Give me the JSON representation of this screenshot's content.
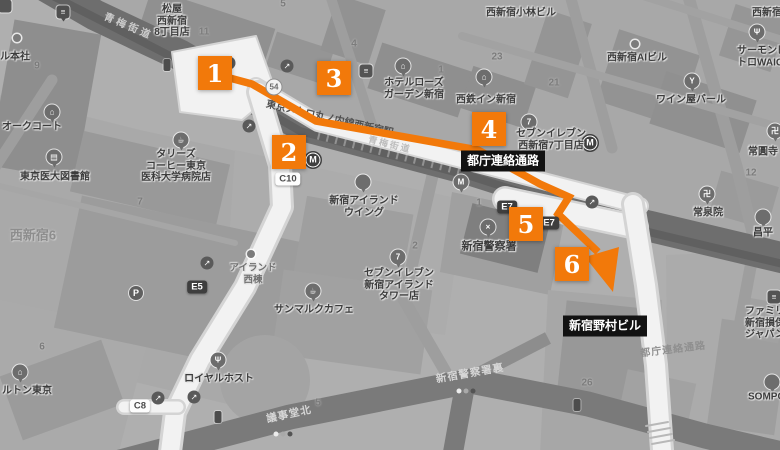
{
  "colors": {
    "route_orange": "#F2790A",
    "label_bg": "#121212",
    "map_background": "#afafaf",
    "road_dark": "#6e6e6e",
    "corridor_white": "#f2f2f2"
  },
  "route": {
    "via_label": "都庁連絡通路",
    "destination_label": "新宿野村ビル",
    "markers": [
      {
        "label": "1",
        "x": 215,
        "y": 73
      },
      {
        "label": "2",
        "x": 289,
        "y": 152
      },
      {
        "label": "3",
        "x": 334,
        "y": 78
      },
      {
        "label": "4",
        "x": 489,
        "y": 129
      },
      {
        "label": "5",
        "x": 526,
        "y": 224
      },
      {
        "label": "6",
        "y": 264,
        "x": 572
      }
    ]
  },
  "black_labels": [
    {
      "name": "tocho-passage-label",
      "text": "都庁連絡通路",
      "x": 503,
      "y": 161
    },
    {
      "name": "nomura-building-label",
      "text": "新宿野村ビル",
      "x": 605,
      "y": 326
    }
  ],
  "pois": [
    {
      "name": "honsha-label",
      "lines": [
        "ル本社"
      ],
      "x": 15,
      "y": 57
    },
    {
      "name": "matsuya-label",
      "lines": [
        "松屋",
        "西新宿",
        "8丁目店"
      ],
      "x": 172,
      "y": 21
    },
    {
      "name": "oak-court-label",
      "lines": [
        "オークコート"
      ],
      "x": 32,
      "y": 127
    },
    {
      "name": "kobayashi-bldg-label",
      "lines": [
        "西新宿小林ビル"
      ],
      "x": 521,
      "y": 13
    },
    {
      "name": "nishi-shinjuku-partial-label",
      "lines": [
        "西新宿"
      ],
      "x": 752,
      "y": 13,
      "align": "left"
    },
    {
      "name": "salmon-waiga-label",
      "lines": [
        "サーモンピ",
        "トロWAIGA"
      ],
      "x": 737,
      "y": 57,
      "align": "left"
    },
    {
      "name": "ai-bldg-label",
      "lines": [
        "西新宿AIビル"
      ],
      "x": 637,
      "y": 58
    },
    {
      "name": "wine-bar-label",
      "lines": [
        "ワイン屋バール"
      ],
      "x": 691,
      "y": 100
    },
    {
      "name": "hotel-rose-garden-label",
      "lines": [
        "ホテルローズ",
        "ガーデン新宿"
      ],
      "x": 414,
      "y": 89
    },
    {
      "name": "nishitetsu-inn-label",
      "lines": [
        "西鉄イン新宿"
      ],
      "x": 486,
      "y": 100
    },
    {
      "name": "seven-eleven-nishi7-label",
      "lines": [
        "セブンイレブン",
        "西新宿7丁目店"
      ],
      "x": 551,
      "y": 140
    },
    {
      "name": "tullys-label",
      "lines": [
        "タリーズ",
        "コーヒー東京",
        "医科大学病院店"
      ],
      "x": 176,
      "y": 166
    },
    {
      "name": "med-library-label",
      "lines": [
        "東京医大図書館"
      ],
      "x": 55,
      "y": 177
    },
    {
      "name": "island-wing-label",
      "lines": [
        "新宿アイランド",
        "ウイング"
      ],
      "x": 364,
      "y": 207
    },
    {
      "name": "island-west-label",
      "lines": [
        "アイランド",
        "西棟"
      ],
      "x": 253,
      "y": 274,
      "size": 9.5,
      "color": "#6f6f6f"
    },
    {
      "name": "seven-eleven-island-label",
      "lines": [
        "セブンイレブン",
        "新宿アイランド",
        "タワー店"
      ],
      "x": 399,
      "y": 285
    },
    {
      "name": "police-hq-label",
      "lines": [
        "新宿警察署"
      ],
      "x": 489,
      "y": 247,
      "size": 11
    },
    {
      "name": "josenin-label",
      "lines": [
        "常泉院"
      ],
      "x": 708,
      "y": 213
    },
    {
      "name": "joenji-label",
      "lines": [
        "常圓寺"
      ],
      "x": 748,
      "y": 152,
      "align": "left"
    },
    {
      "name": "familymart-label",
      "lines": [
        "ファミリー",
        "新宿損保",
        "ジャパン"
      ],
      "x": 745,
      "y": 323,
      "align": "left"
    },
    {
      "name": "shohei-label",
      "lines": [
        "昌平"
      ],
      "x": 763,
      "y": 233
    },
    {
      "name": "sompo-label",
      "lines": [
        "SOMPO"
      ],
      "x": 748,
      "y": 397,
      "align": "left"
    },
    {
      "name": "sanmarc-label",
      "lines": [
        "サンマルクカフェ"
      ],
      "x": 314,
      "y": 310
    },
    {
      "name": "royal-host-label",
      "lines": [
        "ロイヤルホスト"
      ],
      "x": 219,
      "y": 379
    },
    {
      "name": "hilton-label",
      "lines": [
        "ルトン東京"
      ],
      "x": 27,
      "y": 391
    }
  ],
  "area_labels": [
    {
      "name": "district-nishi-shinjuku-6",
      "text": "西新宿6",
      "x": 33,
      "y": 234
    }
  ],
  "road_labels": [
    {
      "name": "ome-kaido-label",
      "text": "青梅街道",
      "x": 129,
      "y": 25,
      "rot": 23,
      "color": "#cccccc",
      "size": 10,
      "ls": 3
    },
    {
      "name": "ome-kaido-label-2",
      "text": "青梅街道",
      "x": 390,
      "y": 144,
      "rot": 14,
      "color": "#bdbdbd",
      "size": 9,
      "ls": 2
    },
    {
      "name": "marunouchi-line-label",
      "text": "東京メトロ丸ノ内線西新宿駅",
      "x": 330,
      "y": 117,
      "rot": 13,
      "color": "#4f4f4f",
      "size": 10,
      "ls": 0
    },
    {
      "name": "gijido-kita-label",
      "text": "議事堂北",
      "x": 289,
      "y": 414,
      "rot": -12,
      "color": "#d6d6d6",
      "size": 10.5,
      "ls": 1
    },
    {
      "name": "police-ura-label",
      "text": "新宿警察署裏",
      "x": 470,
      "y": 373,
      "rot": -10,
      "color": "#d6d6d6",
      "size": 10.5,
      "ls": 1
    },
    {
      "name": "tocho-corridor-label",
      "text": "都庁連絡通路",
      "x": 673,
      "y": 348,
      "rot": -7,
      "color": "#8f8f8f",
      "size": 10,
      "ls": 1
    }
  ],
  "exit_labels": [
    {
      "name": "exit-c10",
      "text": "C10",
      "x": 288,
      "y": 179,
      "dark": false
    },
    {
      "name": "exit-c8",
      "text": "C8",
      "x": 140,
      "y": 406,
      "dark": false
    },
    {
      "name": "exit-e5",
      "text": "E5",
      "x": 197,
      "y": 287,
      "dark": true
    },
    {
      "name": "exit-e7",
      "text": "E7",
      "x": 507,
      "y": 207,
      "dark": true
    },
    {
      "name": "exit-e7",
      "text": "E7",
      "x": 549,
      "y": 223,
      "dark": true
    }
  ],
  "block_numbers": [
    {
      "text": "9",
      "x": 37,
      "y": 66
    },
    {
      "text": "11",
      "x": 204,
      "y": 32
    },
    {
      "text": "5",
      "x": 283,
      "y": 4
    },
    {
      "text": "4",
      "x": 354,
      "y": 44
    },
    {
      "text": "1",
      "x": 441,
      "y": 70
    },
    {
      "text": "23",
      "x": 497,
      "y": 57
    },
    {
      "text": "21",
      "x": 554,
      "y": 83
    },
    {
      "text": "7",
      "x": 140,
      "y": 202
    },
    {
      "text": "2",
      "x": 415,
      "y": 246
    },
    {
      "text": "1",
      "x": 479,
      "y": 203
    },
    {
      "text": "6",
      "x": 42,
      "y": 347
    },
    {
      "text": "26",
      "x": 587,
      "y": 383
    },
    {
      "text": "12",
      "x": 751,
      "y": 173
    },
    {
      "text": "5",
      "x": 318,
      "y": 403
    }
  ],
  "map_icons": [
    {
      "name": "corner-store-icon",
      "type": "sq",
      "glyph": "",
      "x": 5,
      "y": 6
    },
    {
      "name": "bus-stop-icon",
      "type": "bus",
      "glyph": "≡",
      "x": 63,
      "y": 12
    },
    {
      "name": "honsha-icon",
      "type": "dot",
      "x": 17,
      "y": 38
    },
    {
      "name": "oak-court-icon",
      "type": "pin",
      "glyph": "⌂",
      "x": 52,
      "y": 112
    },
    {
      "name": "library-icon",
      "type": "pin",
      "glyph": "▤",
      "x": 54,
      "y": 157
    },
    {
      "name": "tullys-cafe-icon",
      "type": "pin",
      "glyph": "☕",
      "x": 181,
      "y": 140
    },
    {
      "name": "traffic-light-icon",
      "type": "traffic",
      "x": 167,
      "y": 65
    },
    {
      "name": "escalator-icon",
      "type": "esc",
      "glyph": "↗",
      "x": 229,
      "y": 63
    },
    {
      "name": "escalator-icon",
      "type": "esc",
      "glyph": "↗",
      "x": 287,
      "y": 66
    },
    {
      "name": "escalator-icon",
      "type": "esc",
      "glyph": "↗",
      "x": 249,
      "y": 126
    },
    {
      "name": "escalator-icon",
      "type": "esc",
      "glyph": "↗",
      "x": 207,
      "y": 263
    },
    {
      "name": "escalator-icon",
      "type": "esc",
      "glyph": "↗",
      "x": 592,
      "y": 202
    },
    {
      "name": "escalator-icon",
      "type": "esc",
      "glyph": "↗",
      "x": 158,
      "y": 398
    },
    {
      "name": "escalator-icon",
      "type": "esc",
      "glyph": "↗",
      "x": 194,
      "y": 397
    },
    {
      "name": "route-54-badge",
      "type": "badge",
      "glyph": "54",
      "x": 274,
      "y": 87
    },
    {
      "name": "metro-station-icon",
      "type": "metro",
      "glyph": "M",
      "x": 313,
      "y": 160
    },
    {
      "name": "metro-station-icon",
      "type": "metro",
      "glyph": "M",
      "x": 590,
      "y": 143
    },
    {
      "name": "store-icon",
      "type": "sq",
      "glyph": "≡",
      "x": 366,
      "y": 71
    },
    {
      "name": "hotel-rose-garden-icon",
      "type": "pin",
      "glyph": "⌂",
      "x": 403,
      "y": 66
    },
    {
      "name": "nishitetsu-inn-icon",
      "type": "pin",
      "glyph": "⌂",
      "x": 484,
      "y": 77
    },
    {
      "name": "seven-eleven-icon",
      "type": "pin",
      "glyph": "7",
      "x": 529,
      "y": 122
    },
    {
      "name": "wine-bar-icon",
      "type": "pin",
      "glyph": "Y",
      "x": 692,
      "y": 81
    },
    {
      "name": "restaurant-icon",
      "type": "pin",
      "glyph": "Ψ",
      "x": 757,
      "y": 32
    },
    {
      "name": "ai-building-icon",
      "type": "dot",
      "x": 635,
      "y": 44
    },
    {
      "name": "mcdonalds-icon",
      "type": "pin",
      "glyph": "M",
      "x": 461,
      "y": 182
    },
    {
      "name": "island-wing-icon",
      "type": "pin",
      "glyph": "",
      "x": 363,
      "y": 182
    },
    {
      "name": "island-west-icon",
      "type": "dot",
      "x": 251,
      "y": 254
    },
    {
      "name": "seven-eleven-icon",
      "type": "pin",
      "glyph": "7",
      "x": 398,
      "y": 257
    },
    {
      "name": "police-icon",
      "type": "pin",
      "glyph": "×",
      "x": 488,
      "y": 227
    },
    {
      "name": "temple-manji-icon",
      "type": "pin",
      "glyph": "卍",
      "x": 707,
      "y": 194
    },
    {
      "name": "temple-manji-icon",
      "type": "pin",
      "glyph": "卍",
      "x": 775,
      "y": 131
    },
    {
      "name": "shohei-icon",
      "type": "pin",
      "glyph": "",
      "x": 763,
      "y": 217
    },
    {
      "name": "familymart-icon",
      "type": "sq",
      "glyph": "≡",
      "x": 774,
      "y": 297
    },
    {
      "name": "sompo-icon",
      "type": "pin",
      "glyph": "",
      "x": 772,
      "y": 382
    },
    {
      "name": "sanmarc-cafe-icon",
      "type": "pin",
      "glyph": "☕",
      "x": 313,
      "y": 291
    },
    {
      "name": "royal-host-icon",
      "type": "pin",
      "glyph": "Ψ",
      "x": 218,
      "y": 360
    },
    {
      "name": "hilton-icon",
      "type": "pin",
      "glyph": "⌂",
      "x": 20,
      "y": 372
    },
    {
      "name": "parking-icon",
      "type": "p",
      "glyph": "P",
      "x": 136,
      "y": 293
    },
    {
      "name": "signal-dots-icon",
      "type": "signals",
      "x": 466,
      "y": 391
    },
    {
      "name": "signal-dots-icon",
      "type": "signals",
      "x": 283,
      "y": 434
    },
    {
      "name": "traffic-light-icon",
      "type": "traffic",
      "x": 577,
      "y": 405
    },
    {
      "name": "traffic-light-icon",
      "type": "traffic",
      "x": 218,
      "y": 417
    }
  ]
}
